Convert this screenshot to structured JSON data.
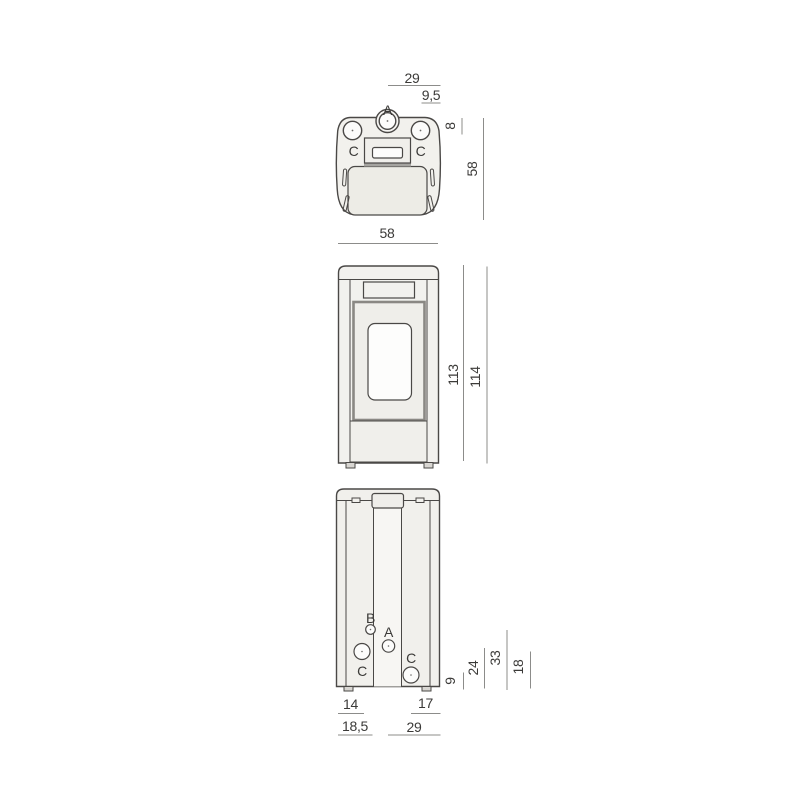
{
  "colors": {
    "background": "#ffffff",
    "outline": "#4a4846",
    "dimension_line": "#8c8c8a",
    "text": "#3b3a38",
    "body_fill": "#f2f1ed",
    "panel_fill": "#edece6",
    "window_fill": "#fdfdfc",
    "frame_gray": "#8a8884",
    "shadow_band": "#a5a4a0",
    "feet_fill": "#d8d6d2"
  },
  "top_view": {
    "labels": {
      "a": "A",
      "c_left": "C",
      "c_right": "C"
    },
    "dims": {
      "top_29": "29",
      "top_9_5": "9,5",
      "side_8": "8",
      "side_58": "58",
      "bottom_58": "58"
    }
  },
  "front_view": {
    "dims": {
      "height_113": "113",
      "height_114": "114"
    }
  },
  "rear_view": {
    "labels": {
      "b": "B",
      "a": "A",
      "c_left": "C",
      "c_right": "C"
    },
    "dims": {
      "side_9": "9",
      "side_24": "24",
      "side_33": "33",
      "side_18": "18",
      "bottom_14": "14",
      "bottom_17": "17",
      "bottom_18_5": "18,5",
      "bottom_29": "29"
    }
  }
}
